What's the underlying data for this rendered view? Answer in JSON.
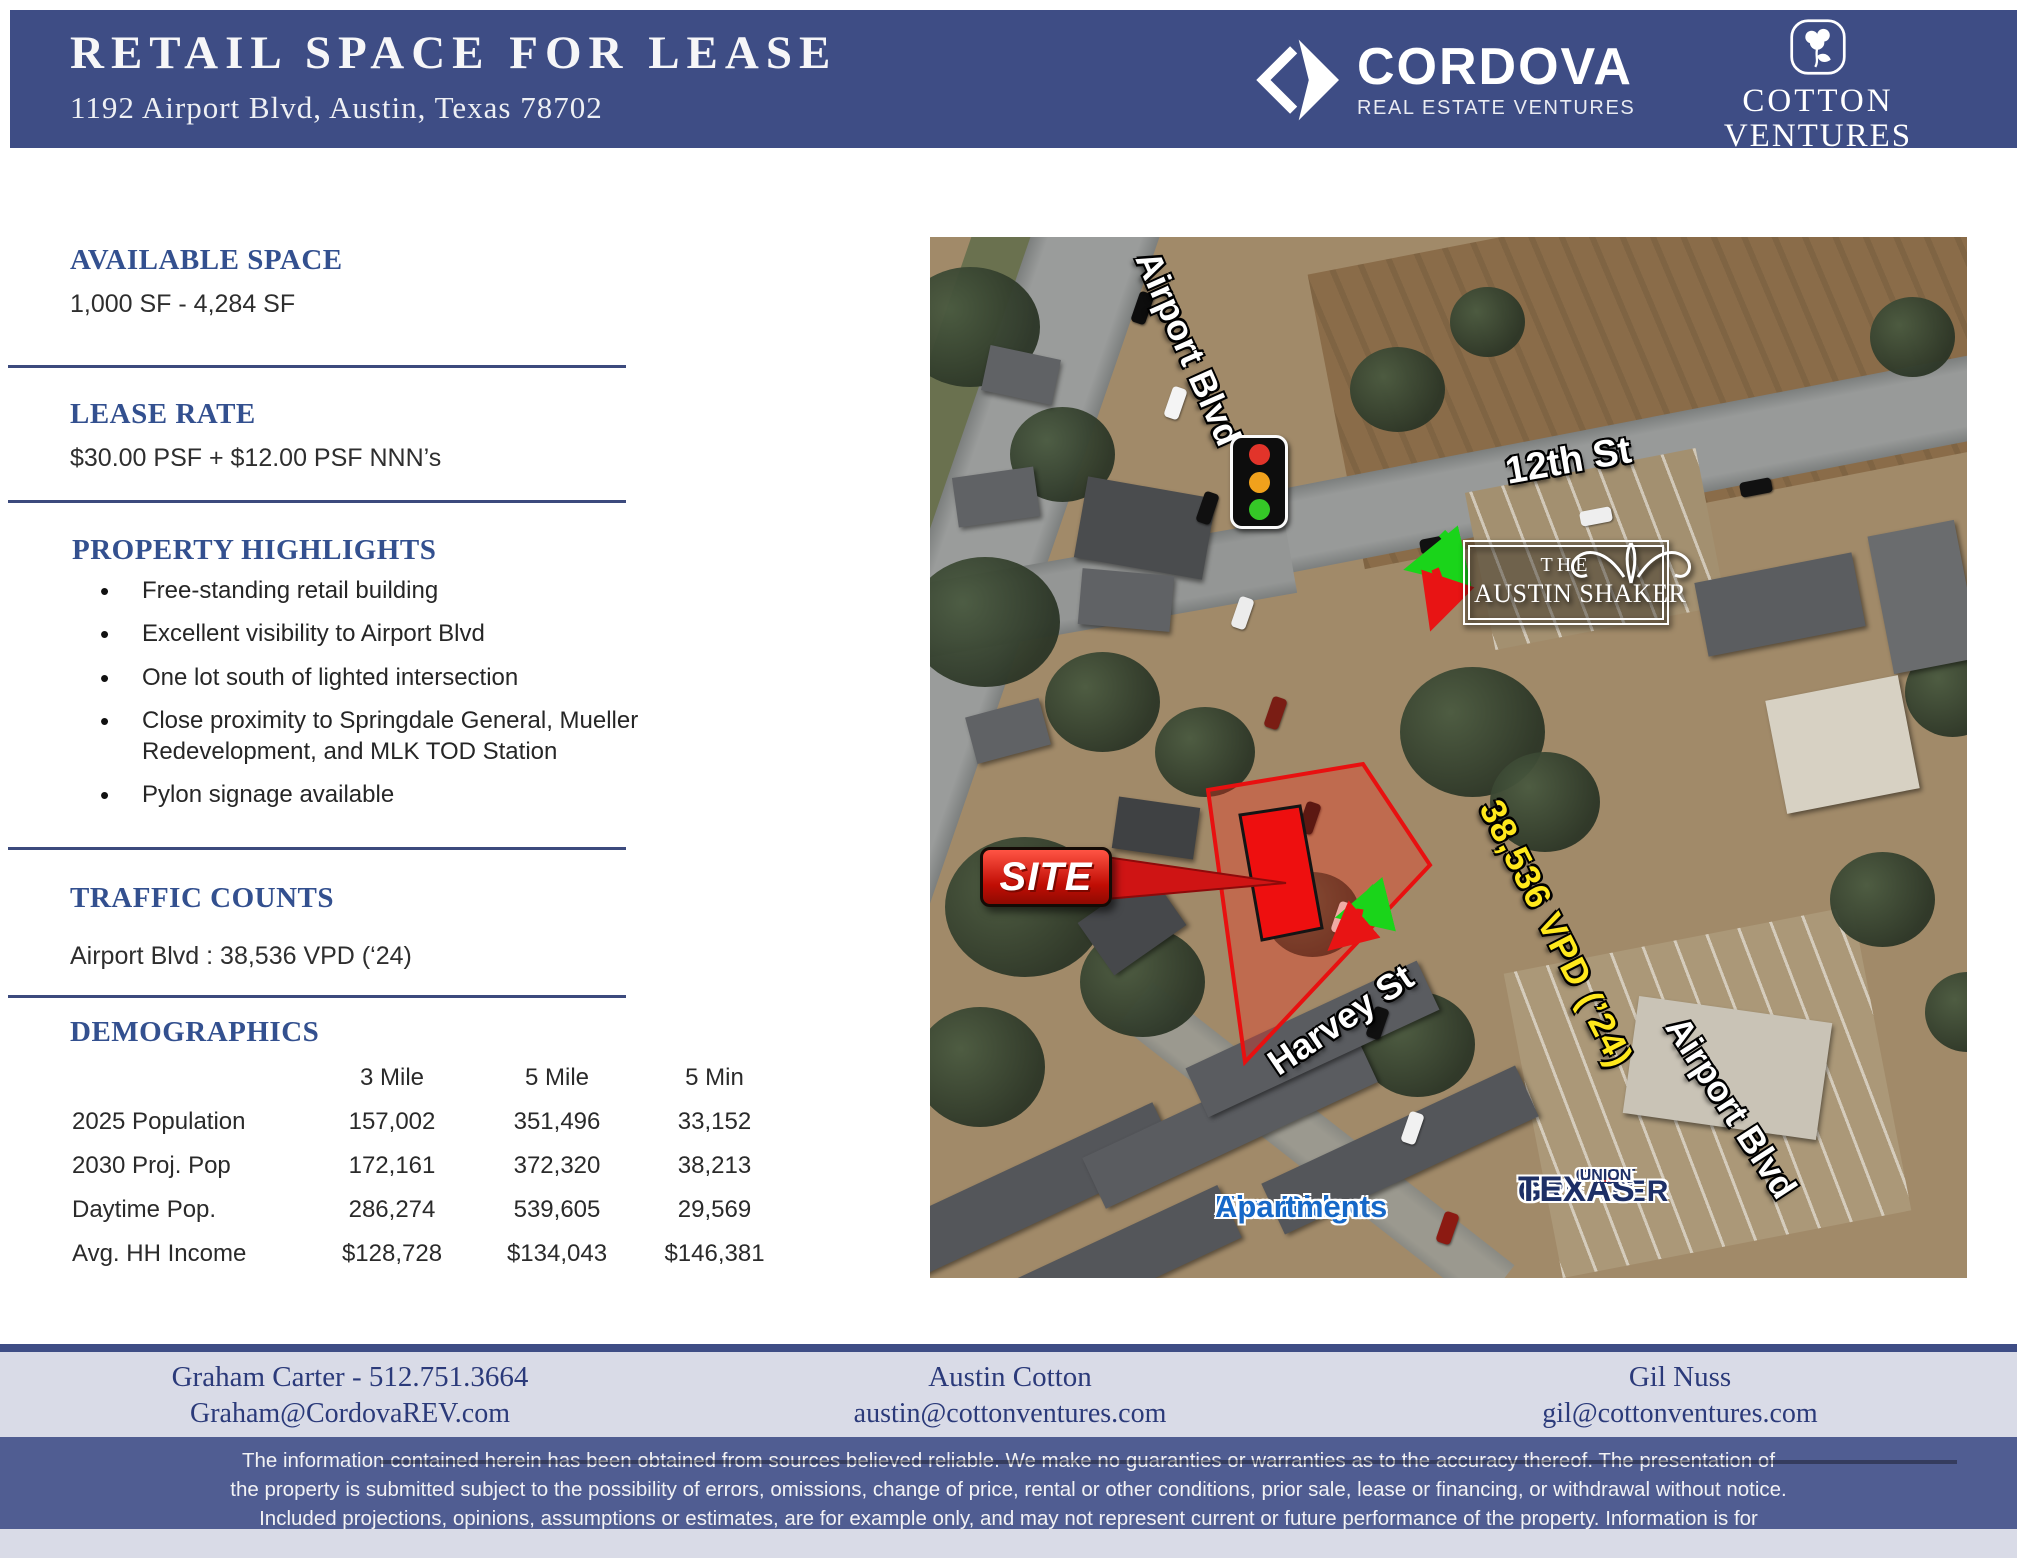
{
  "header": {
    "title": "RETAIL SPACE FOR LEASE",
    "subtitle": "1192 Airport Blvd, Austin, Texas 78702",
    "cordova": {
      "name": "CORDOVA",
      "tagline": "REAL ESTATE VENTURES"
    },
    "cotton": {
      "line1": "COTTON",
      "line2": "VENTURES"
    }
  },
  "available_space": {
    "heading": "AVAILABLE SPACE",
    "value": "1,000 SF - 4,284 SF"
  },
  "lease_rate": {
    "heading": "LEASE RATE",
    "value": "$30.00 PSF + $12.00 PSF NNN’s"
  },
  "property_highlights": {
    "heading": "PROPERTY HIGHLIGHTS",
    "bullets": [
      "Free-standing retail building",
      "Excellent visibility to Airport Blvd",
      "One lot south of lighted intersection",
      "Close proximity to Springdale General, Mueller Redevelopment, and MLK TOD Station",
      "Pylon signage available"
    ]
  },
  "traffic_counts": {
    "heading": "TRAFFIC COUNTS",
    "value": "Airport Blvd : 38,536 VPD (‘24)"
  },
  "demographics": {
    "heading": "DEMOGRAPHICS",
    "columns": [
      "3 Mile",
      "5 Mile",
      "5 Min"
    ],
    "rows": [
      {
        "label": "2025 Population",
        "values": [
          "157,002",
          "351,496",
          "33,152"
        ]
      },
      {
        "label": "2030 Proj. Pop",
        "values": [
          "172,161",
          "372,320",
          "38,213"
        ]
      },
      {
        "label": "Daytime Pop.",
        "values": [
          "286,274",
          "539,605",
          "29,569"
        ]
      },
      {
        "label": "Avg. HH Income",
        "values": [
          "$128,728",
          "$134,043",
          "$146,381"
        ]
      }
    ]
  },
  "map": {
    "labels": {
      "airport_blvd_top": "Airport Blvd",
      "twelfth_st": "12th St",
      "vpd": "38,536 VPD (’24)",
      "harvey_st": "Harvey St",
      "site": "SITE",
      "elm_ridge_1": "Elm Ridge",
      "elm_ridge_2": "Apartments",
      "austin_shaker_the": "THE",
      "austin_shaker_name": "AUSTIN SHAKER",
      "greater": "GREATER",
      "texas": "TEXAS",
      "credit": "CREDIT",
      "union": "UNION",
      "airport_blvd_bottom": "Airport Blvd"
    }
  },
  "footer": {
    "contacts": [
      {
        "name": "Graham Carter - 512.751.3664",
        "email": "Graham@CordovaREV.com"
      },
      {
        "name": "Austin Cotton",
        "email": "austin@cottonventures.com"
      },
      {
        "name": "Gil Nuss",
        "email": "gil@cottonventures.com"
      }
    ],
    "disclaimer": "The information contained herein has been obtained from sources believed reliable. We make no guaranties or warranties as to the accuracy thereof. The presentation of the property is submitted subject to the possibility of errors, omissions, change of price, rental or other conditions, prior sale, lease or financing, or withdrawal without notice. Included projections, opinions, assumptions or estimates, are for example only, and may not represent current or future performance of the property. Information is for guidance only and does not constitute all or any part of a contract."
  }
}
